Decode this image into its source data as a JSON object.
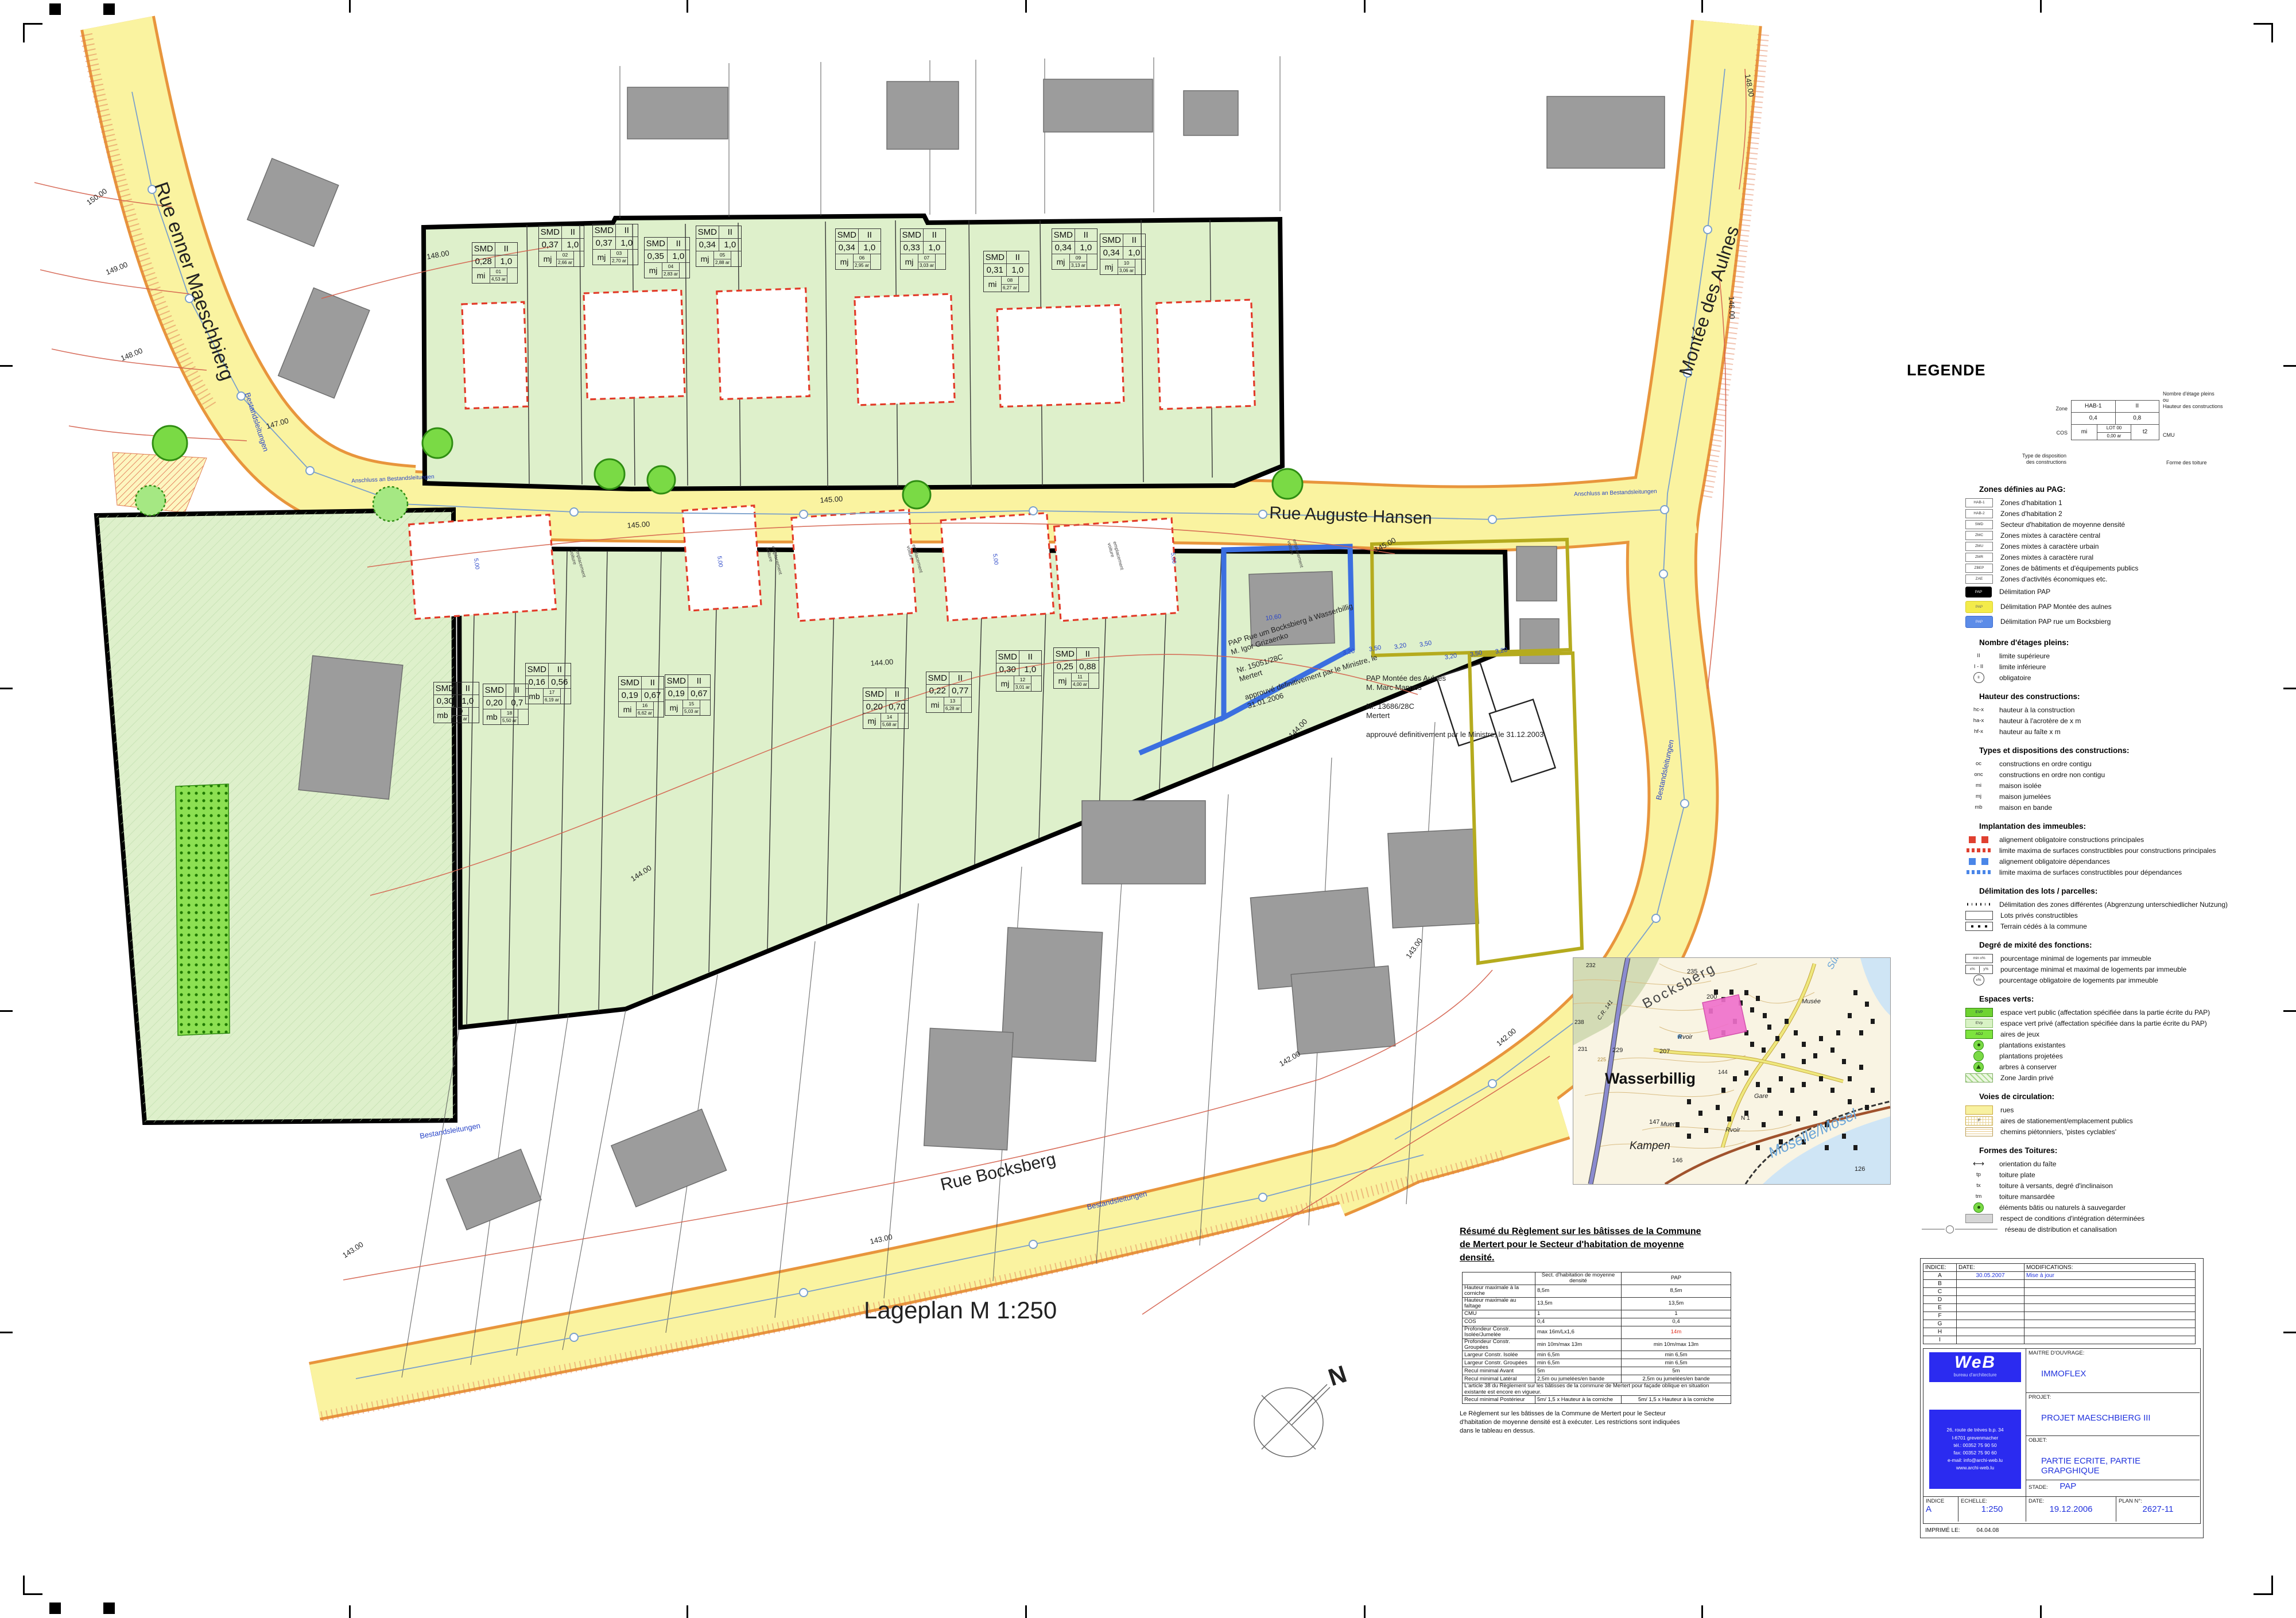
{
  "plan_labels": [
    {
      "id": "rue_maeschbierg",
      "text": "Rue enner Maeschbierg"
    },
    {
      "id": "rue_hansen",
      "text": "Rue Auguste Hansen"
    },
    {
      "id": "montee_aulnes",
      "text": "Montée des Aulnes"
    },
    {
      "id": "rue_bocksberg",
      "text": "Rue Bocksberg"
    },
    {
      "id": "lageplan",
      "text": "Lageplan M 1:250"
    },
    {
      "id": "north_n",
      "text": "N"
    },
    {
      "id": "c150",
      "text": "150.00"
    },
    {
      "id": "c149",
      "text": "149.00"
    },
    {
      "id": "c148a",
      "text": "148.00"
    },
    {
      "id": "c148b",
      "text": "148.00"
    },
    {
      "id": "c148c",
      "text": "148.00"
    },
    {
      "id": "c147a",
      "text": "147.00"
    },
    {
      "id": "c146a",
      "text": "146.00"
    },
    {
      "id": "c145a",
      "text": "145.00"
    },
    {
      "id": "c145b",
      "text": "145.00"
    },
    {
      "id": "c145c",
      "text": "145.00"
    },
    {
      "id": "c144a",
      "text": "144.00"
    },
    {
      "id": "c144b",
      "text": "144.00"
    },
    {
      "id": "c144c",
      "text": "144.00"
    },
    {
      "id": "c143a",
      "text": "143.00"
    },
    {
      "id": "c143b",
      "text": "143.00"
    },
    {
      "id": "c143c",
      "text": "143.00"
    },
    {
      "id": "c142a",
      "text": "142.00"
    },
    {
      "id": "c142b",
      "text": "142.00"
    },
    {
      "id": "bestand_left",
      "text": "Bestandsleitungen"
    },
    {
      "id": "bestand_montee",
      "text": "Bestandsleitungen"
    },
    {
      "id": "bestand_bocks1",
      "text": "Bestandsleitungen"
    },
    {
      "id": "bestand_bocks2",
      "text": "Bestandsleitungen"
    },
    {
      "id": "anschluss_left",
      "text": "Anschluss an Bestandsleitungen"
    },
    {
      "id": "anschluss_right",
      "text": "Anschluss an Bestandsleitungen"
    },
    {
      "id": "d1060",
      "text": "10,60"
    },
    {
      "id": "d320a",
      "text": "3,20"
    },
    {
      "id": "d350a",
      "text": "3,50"
    },
    {
      "id": "d320b",
      "text": "3,20"
    },
    {
      "id": "d350b",
      "text": "3,50"
    },
    {
      "id": "d320c",
      "text": "3,20"
    },
    {
      "id": "d350c",
      "text": "3,50"
    },
    {
      "id": "d320d",
      "text": "3,20"
    },
    {
      "id": "d500a",
      "text": "5,00"
    },
    {
      "id": "d500b",
      "text": "5,00"
    },
    {
      "id": "d500c",
      "text": "5,00"
    },
    {
      "id": "d500d",
      "text": "5,00"
    },
    {
      "id": "emp1",
      "text": "emplacement\nvoiture"
    },
    {
      "id": "emp2",
      "text": "emplacement\nvoiture"
    },
    {
      "id": "emp3",
      "text": "emplacement\nvoiture"
    },
    {
      "id": "emp4",
      "text": "emplacement\nvoiture"
    },
    {
      "id": "emp5",
      "text": "emplacement\nvoiture"
    },
    {
      "id": "annot_bocks",
      "text": "PAP Rue um Bocksbierg à Wasserbillig\nM. Igor Grizaenko\n\nNr. 15051/28C\nMertert\n\napprouvé definitivement par le Ministre, le\n31.01.2006"
    },
    {
      "id": "annot_aulnes",
      "text": "PAP Montée des Aulnes\nM. Marc Mannes\n\nNr. 13686/28C\nMertert\n\napprouvé definitivement par le Ministre, le 31.12.2003"
    }
  ],
  "lots": [
    {
      "no": "01",
      "zone": "SMD",
      "storeys": "II",
      "cos": "0,28",
      "cmu": "1,0",
      "type": "mi",
      "area": "4,53 ar"
    },
    {
      "no": "02",
      "zone": "SMD",
      "storeys": "II",
      "cos": "0,37",
      "cmu": "1,0",
      "type": "mj",
      "area": "2,66 ar"
    },
    {
      "no": "03",
      "zone": "SMD",
      "storeys": "II",
      "cos": "0,37",
      "cmu": "1,0",
      "type": "mj",
      "area": "2,70 ar"
    },
    {
      "no": "04",
      "zone": "SMD",
      "storeys": "II",
      "cos": "0,35",
      "cmu": "1,0",
      "type": "mj",
      "area": "2,83 ar"
    },
    {
      "no": "05",
      "zone": "SMD",
      "storeys": "II",
      "cos": "0,34",
      "cmu": "1,0",
      "type": "mj",
      "area": "2,88 ar"
    },
    {
      "no": "06",
      "zone": "SMD",
      "storeys": "II",
      "cos": "0,34",
      "cmu": "1,0",
      "type": "mj",
      "area": "2,95 ar"
    },
    {
      "no": "07",
      "zone": "SMD",
      "storeys": "II",
      "cos": "0,33",
      "cmu": "1,0",
      "type": "mj",
      "area": "3,03 ar"
    },
    {
      "no": "08",
      "zone": "SMD",
      "storeys": "II",
      "cos": "0,31",
      "cmu": "1,0",
      "type": "mi",
      "area": "6,27 ar"
    },
    {
      "no": "09",
      "zone": "SMD",
      "storeys": "II",
      "cos": "0,34",
      "cmu": "1,0",
      "type": "mj",
      "area": "3,13 ar"
    },
    {
      "no": "10",
      "zone": "SMD",
      "storeys": "II",
      "cos": "0,34",
      "cmu": "1,0",
      "type": "mj",
      "area": "3,06 ar"
    },
    {
      "no": "11",
      "zone": "SMD",
      "storeys": "II",
      "cos": "0,25",
      "cmu": "0,88",
      "type": "mj",
      "area": "4,00 ar"
    },
    {
      "no": "12",
      "zone": "SMD",
      "storeys": "II",
      "cos": "0,30",
      "cmu": "1,0",
      "type": "mj",
      "area": "3,01 ar"
    },
    {
      "no": "13",
      "zone": "SMD",
      "storeys": "II",
      "cos": "0,22",
      "cmu": "0,77",
      "type": "mi",
      "area": "6,28 ar"
    },
    {
      "no": "14",
      "zone": "SMD",
      "storeys": "II",
      "cos": "0,20",
      "cmu": "0,70",
      "type": "mj",
      "area": "5,68 ar"
    },
    {
      "no": "15",
      "zone": "SMD",
      "storeys": "II",
      "cos": "0,19",
      "cmu": "0,67",
      "type": "mj",
      "area": "5,03 ar"
    },
    {
      "no": "16",
      "zone": "SMD",
      "storeys": "II",
      "cos": "0,19",
      "cmu": "0,67",
      "type": "mi",
      "area": "6,62 ar"
    },
    {
      "no": "17",
      "zone": "SMD",
      "storeys": "II",
      "cos": "0,16",
      "cmu": "0,56",
      "type": "mb",
      "area": "6,19 ar"
    },
    {
      "no": "18",
      "zone": "SMD",
      "storeys": "II",
      "cos": "0,20",
      "cmu": "0,7",
      "type": "mb",
      "area": "5,50 ar"
    },
    {
      "no": "19",
      "zone": "SMD",
      "storeys": "II",
      "cos": "0,30",
      "cmu": "1,0",
      "type": "mb",
      "area": "4,55 ar"
    }
  ],
  "legend": {
    "title": "LEGENDE",
    "key": {
      "zone": "HAB-1",
      "storeys": "II",
      "cos": "0,4",
      "cmu": "0,8",
      "type": "mi",
      "lot": "LOT 00",
      "area": "0,00 ar",
      "roof": "t2",
      "callouts": {
        "zone": "Zone",
        "floors": "Nombre d'étage pleins\nou\nHauteur des constructions",
        "cos": "COS",
        "cmu": "CMU",
        "type": "Type de disposition\ndes constructions",
        "roof": "Forme des toiture"
      }
    },
    "sections": [
      {
        "header": "Zones définies au PAG:",
        "items": [
          {
            "swatch": "zonebox",
            "swatch_text": "HAB-1",
            "label": "Zones d'habitation 1"
          },
          {
            "swatch": "zonebox",
            "swatch_text": "HAB-2",
            "label": "Zones d'habitation 2"
          },
          {
            "swatch": "zonebox",
            "swatch_text": "SMD",
            "label": "Secteur d'habitation de moyenne densité"
          },
          {
            "swatch": "zonebox",
            "swatch_text": "ZMC",
            "label": "Zones mixtes à caractère central"
          },
          {
            "swatch": "zonebox",
            "swatch_text": "ZMU",
            "label": "Zones mixtes à caractère urbain"
          },
          {
            "swatch": "zonebox",
            "swatch_text": "ZMR",
            "label": "Zones mixtes à caractère rural"
          },
          {
            "swatch": "zonebox",
            "swatch_text": "ZBEP",
            "label": "Zones de bâtiments et d'équipements publics"
          },
          {
            "swatch": "zonebox",
            "swatch_text": "ZAE",
            "label": "Zones d'activités économiques etc."
          },
          {
            "swatch": "papblack",
            "swatch_text": "PAP",
            "label": "Délimitation PAP"
          },
          {
            "swatch": "papyellow",
            "swatch_text": "PAP",
            "label": "Délimitation PAP Montée des aulnes"
          },
          {
            "swatch": "papblue",
            "swatch_text": "PAP",
            "label": "Délimitation PAP rue um Bocksbierg"
          }
        ]
      },
      {
        "header": "Nombre d'étages pleins:",
        "items": [
          {
            "swatch": "text",
            "swatch_text": "II",
            "label": "limite supérieure"
          },
          {
            "swatch": "text",
            "swatch_text": "I - II",
            "label": "limite inférieure"
          },
          {
            "swatch": "circtext",
            "swatch_text": "II",
            "label": "obligatoire"
          }
        ]
      },
      {
        "header": "Hauteur des constructions:",
        "items": [
          {
            "swatch": "text",
            "swatch_text": "hc-x",
            "label": "hauteur à la construction"
          },
          {
            "swatch": "text",
            "swatch_text": "ha-x",
            "label": "hauteur à l'acrotère de x m"
          },
          {
            "swatch": "text",
            "swatch_text": "hf-x",
            "label": "hauteur au faîte x m"
          }
        ]
      },
      {
        "header": "Types et dispositions des constructions:",
        "items": [
          {
            "swatch": "text",
            "swatch_text": "oc",
            "label": "constructions en ordre contigu"
          },
          {
            "swatch": "text",
            "swatch_text": "onc",
            "label": "constructions en ordre non contigu"
          },
          {
            "swatch": "text",
            "swatch_text": "mi",
            "label": "maison isolée"
          },
          {
            "swatch": "text",
            "swatch_text": "mj",
            "label": "maison jumelées"
          },
          {
            "swatch": "text",
            "swatch_text": "mb",
            "label": "maison en bande"
          }
        ]
      },
      {
        "header": "Implantation des immeubles:",
        "items": [
          {
            "swatch": "redsq",
            "label": "alignement obligatoire constructions principales"
          },
          {
            "swatch": "reddash",
            "label": "limite maxima de surfaces constructibles pour constructions principales"
          },
          {
            "swatch": "bluesq",
            "label": "alignement obligatoire dépendances"
          },
          {
            "swatch": "bluedash",
            "label": "limite maxima de surfaces constructibles pour dépendances"
          }
        ]
      },
      {
        "header": "Délimitation des lots / parcelles:",
        "items": [
          {
            "swatch": "dotline",
            "label": "Délimitation des zones différentes (Abgrenzung unterschiedlicher Nutzung)"
          },
          {
            "swatch": "emptybox",
            "label": "Lots privés constructibles"
          },
          {
            "swatch": "dotbox",
            "label": "Terrain cédés à la commune"
          }
        ]
      },
      {
        "header": "Degré de mixité des fonctions:",
        "items": [
          {
            "swatch": "minbox",
            "swatch_text": "min x%",
            "label": "pourcentage minimal de logements par immeuble"
          },
          {
            "swatch": "splitbox",
            "swatch_text": "x%|y%",
            "label": "pourcentage minimal et maximal de logements par immeuble"
          },
          {
            "swatch": "circtext",
            "swatch_text": "x%",
            "label": "pourcentage obligatoire de logements par immeuble"
          }
        ]
      },
      {
        "header": "Espaces verts:",
        "items": [
          {
            "swatch": "evp",
            "swatch_text": "EVP",
            "label": "espace vert public (affectation spécifiée dans la partie écrite du PAP)"
          },
          {
            "swatch": "evpr",
            "swatch_text": "EVp",
            "label": "espace vert privé (affectation spécifiée dans la partie écrite du PAP)"
          },
          {
            "swatch": "adj",
            "swatch_text": "ADJ",
            "label": "aires de jeux"
          },
          {
            "swatch": "circdot",
            "label": "plantations existantes"
          },
          {
            "swatch": "circgreen",
            "label": "plantations projetées"
          },
          {
            "swatch": "circtri",
            "label": "arbres à conserver"
          },
          {
            "swatch": "hatchgreen",
            "label": "Zone Jardin privé"
          }
        ]
      },
      {
        "header": "Voies de circulation:",
        "items": [
          {
            "swatch": "yellowbox",
            "label": "rues"
          },
          {
            "swatch": "gridbox",
            "swatch_text": "P",
            "label": "aires de stationement/emplacement publics"
          },
          {
            "swatch": "linesbox",
            "label": "chemins piétonniers, 'pistes cyclables'"
          }
        ]
      },
      {
        "header": "Formes des Toitures:",
        "items": [
          {
            "swatch": "arrow",
            "label": "orientation du faîte"
          },
          {
            "swatch": "text",
            "swatch_text": "tp",
            "label": "toiture plate"
          },
          {
            "swatch": "text",
            "swatch_text": "tx",
            "label": "toiture à versants, degré d'inclinaison"
          },
          {
            "swatch": "text",
            "swatch_text": "tm",
            "label": "toiture mansardée"
          },
          {
            "swatch": "circdot",
            "label": "éléments bâtis ou naturels à sauvegarder"
          },
          {
            "swatch": "graybox",
            "label": "respect de conditions d'intégration déterminées"
          }
        ]
      },
      {
        "header": "",
        "items": [
          {
            "swatch": "linecircle",
            "label": "réseau de distribution et canalisation",
            "wide": true
          }
        ]
      }
    ]
  },
  "regulation": {
    "heading": "Résumé du Règlement sur les bâtisses de la Commune de Mertert pour le Secteur d'habitation de moyenne densité.",
    "cols": [
      "",
      "Sect. d'habitation de moyenne densité",
      "PAP"
    ],
    "rows": [
      {
        "cells": [
          "Hauteur maximale à la corniche",
          "8,5m",
          "8,5m"
        ]
      },
      {
        "cells": [
          "Hauteur maximale au faîtage",
          "13,5m",
          "13,5m"
        ]
      },
      {
        "cells": [
          "CMU",
          "1",
          "1"
        ]
      },
      {
        "cells": [
          "COS",
          "0,4",
          "0,4"
        ]
      },
      {
        "cells": [
          "Profondeur Constr. Isolée/Jumelée",
          "max 16m/Lx1,6",
          "14m"
        ],
        "red": 2
      },
      {
        "cells": [
          "Profondeur Constr. Groupées",
          "min 10m/max 13m",
          "min 10m/max 13m"
        ]
      },
      {
        "cells": [
          "Largeur Constr. Isolée",
          "min 6,5m",
          "min 6,5m"
        ]
      },
      {
        "cells": [
          "Largeur Constr. Groupées",
          "min 6,5m",
          "min 6,5m"
        ]
      },
      {
        "cells": [
          "Recul minimal Avant",
          "5m",
          "5m"
        ]
      },
      {
        "cells": [
          "Recul minimal Latéral",
          "2,5m ou jumelées/en bande",
          "2,5m ou jumelées/en bande"
        ]
      },
      {
        "note": "L'article 38 du Règlement sur les bâtisses de la commune de Mertert pour façade oblique en situation existante est encore en vigueur."
      },
      {
        "cells": [
          "Recul minimal Postérieur",
          "5m/ 1,5 x Hauteur à la corniche",
          "5m/ 1,5 x Hauteur à la corniche"
        ]
      }
    ],
    "paragraph": "Le Règlement sur les bâtisses de la Commune de Mertert pour le Secteur d'habitation de moyenne densité est à exécuter. Les restrictions sont indiquées dans le tableau en dessus."
  },
  "title_block": {
    "indices": {
      "header": {
        "indice": "INDICE:",
        "date": "DATE:",
        "modifications": "MODIFICATIONS:"
      },
      "rows": [
        {
          "l": "A",
          "d": "30.05.2007",
          "m": "Mise à jour"
        },
        {
          "l": "B",
          "d": "",
          "m": ""
        },
        {
          "l": "C",
          "d": "",
          "m": ""
        },
        {
          "l": "D",
          "d": "",
          "m": ""
        },
        {
          "l": "E",
          "d": "",
          "m": ""
        },
        {
          "l": "F",
          "d": "",
          "m": ""
        },
        {
          "l": "G",
          "d": "",
          "m": ""
        },
        {
          "l": "H",
          "d": "",
          "m": ""
        },
        {
          "l": "I",
          "d": "",
          "m": ""
        }
      ]
    },
    "logo": {
      "name": "WeB",
      "tagline": "bureau d'architecture"
    },
    "address": [
      "26, route de trèves b.p. 34",
      "l-6701        grevenmacher",
      "tél.:  00352 75 90 50",
      "fax:  00352 75 90 60",
      "e-mail: info@archi-web.lu",
      "www.archi-web.lu"
    ],
    "fields": {
      "maitre_label": "MAITRE D'OUVRAGE:",
      "maitre": "IMMOFLEX",
      "projet_label": "PROJET:",
      "projet": "PROJET MAESCHBIERG III",
      "objet_label": "OBJET:",
      "objet": "PARTIE ECRITE, PARTIE GRAPGHIQUE",
      "stade_label": "STADE:",
      "stade": "PAP",
      "indice_label": "INDICE",
      "indice": "A",
      "echelle_label": "ECHELLE:",
      "echelle": "1:250",
      "date_label": "DATE:",
      "date": "19.12.2006",
      "plan_label": "PLAN N°:",
      "plan_no": "2627-11",
      "imprime_label": "IMPRIMÉ LE:",
      "imprime": "04.04.08"
    }
  },
  "inset_labels": [
    {
      "id": "bocksberg",
      "text": "Bocksberg"
    },
    {
      "id": "wasserbillig",
      "text": "Wasserbillig"
    },
    {
      "id": "kampen",
      "text": "Kampen"
    },
    {
      "id": "moselle",
      "text": "Moselle/Mosel"
    },
    {
      "id": "sure",
      "text": "Sûre/Sauer"
    },
    {
      "id": "musee",
      "text": "Musée"
    },
    {
      "id": "gare",
      "text": "Gare"
    },
    {
      "id": "rvoir1",
      "text": "Rvoir"
    },
    {
      "id": "rvoir2",
      "text": "Rvoir"
    },
    {
      "id": "muer",
      "text": "Muer"
    },
    {
      "id": "n235",
      "text": "235"
    },
    {
      "id": "n200",
      "text": "200"
    },
    {
      "id": "n207",
      "text": "207"
    },
    {
      "id": "n229",
      "text": "229"
    },
    {
      "id": "n231",
      "text": "231"
    },
    {
      "id": "n232",
      "text": "232"
    },
    {
      "id": "n238",
      "text": "238"
    },
    {
      "id": "n225",
      "text": "225"
    },
    {
      "id": "n146",
      "text": "146"
    },
    {
      "id": "n147",
      "text": "147"
    },
    {
      "id": "n144i",
      "text": "144"
    },
    {
      "id": "n126",
      "text": "126"
    },
    {
      "id": "cr141",
      "text": "C.R. 141"
    },
    {
      "id": "n1road",
      "text": "N 1"
    }
  ]
}
